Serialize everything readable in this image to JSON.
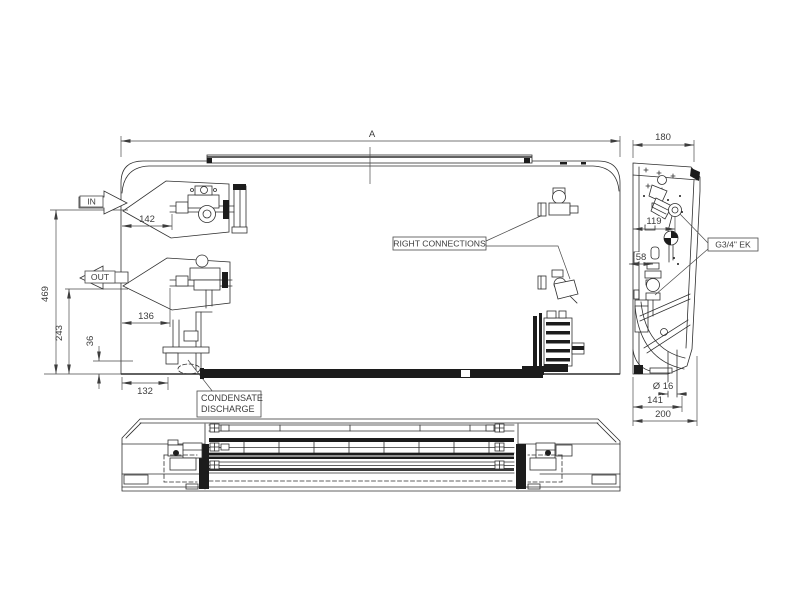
{
  "colors": {
    "background": "#ffffff",
    "line": "#2f2f2f",
    "text": "#3d3d3d"
  },
  "front_view": {
    "dim_width_label": "A",
    "dim_height_total": "469",
    "dim_height_out": "243",
    "dim_tray_height": "36",
    "dim_in_offset": "142",
    "dim_out_offset": "136",
    "dim_drain_offset": "132",
    "in_label": "IN",
    "out_label": "OUT",
    "right_connections_label": "RIGHT  CONNECTIONS",
    "condensate_label_line1": "CONDENSATE",
    "condensate_label_line2": "DISCHARGE"
  },
  "side_view": {
    "dim_depth_top": "180",
    "dim_valve_offset": "119",
    "dim_pipe_offset": "58",
    "dim_drain_diameter": "Ø 16",
    "dim_depth_mid": "141",
    "dim_depth_total": "200",
    "fitting_label": "G3/4\" EK"
  }
}
